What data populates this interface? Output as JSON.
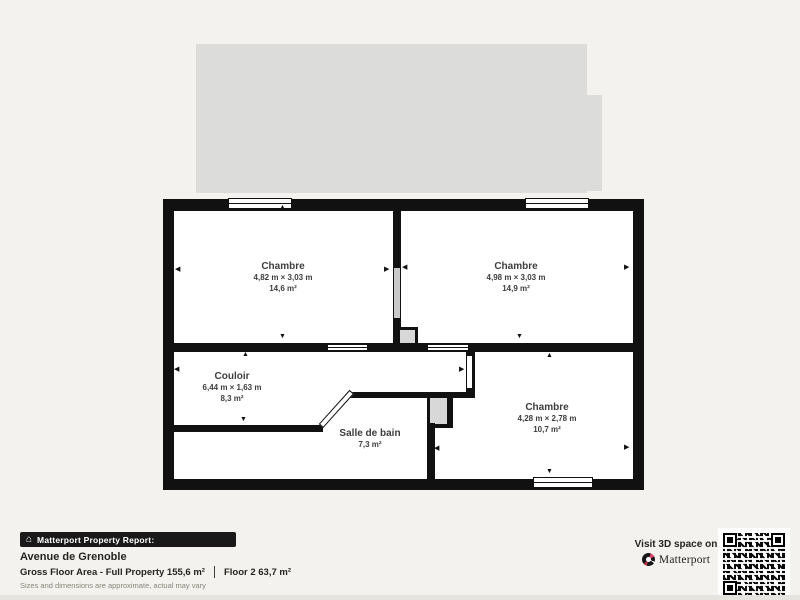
{
  "colors": {
    "background": "#f3f2ee",
    "wall": "#111111",
    "underlay": "#dcdcda",
    "brand_pink": "#d9446b"
  },
  "plan": {
    "rooms": [
      {
        "name": "Chambre",
        "dims": "4,82 m × 3,03 m",
        "area": "14,6 m²"
      },
      {
        "name": "Chambre",
        "dims": "4,98 m × 3,03 m",
        "area": "14,9 m²"
      },
      {
        "name": "Chambre",
        "dims": "4,28 m × 2,78 m",
        "area": "10,7 m²"
      },
      {
        "name": "Couloir",
        "dims": "6,44 m × 1,63 m",
        "area": "8,3 m²"
      },
      {
        "name": "Salle de bain",
        "area": "7,3 m²"
      }
    ]
  },
  "footer": {
    "badge": "Matterport Property Report:",
    "address": "Avenue de Grenoble",
    "gross_area": "Gross Floor Area - Full Property 155,6 m²",
    "floor_area": "Floor 2 63,7 m²",
    "disclaimer": "Sizes and dimensions are approximate, actual may vary"
  },
  "cta": {
    "line": "Visit 3D space on",
    "brand": "Matterport"
  }
}
